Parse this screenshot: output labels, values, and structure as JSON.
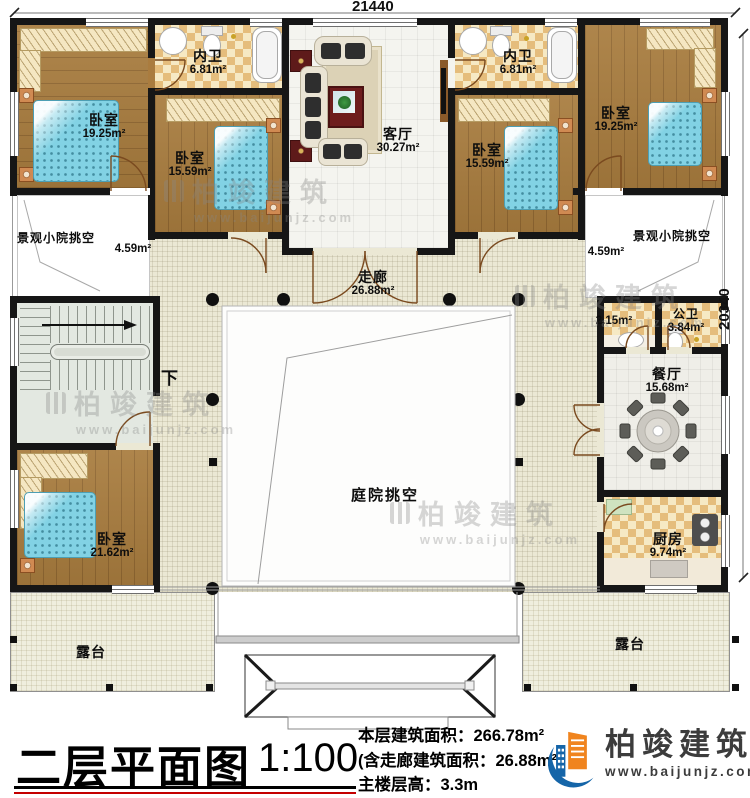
{
  "dimensions": {
    "width_top": "21440",
    "height_right": "20340"
  },
  "rooms": {
    "bedroom_top_left": {
      "label": "卧室",
      "area": "19.25m²"
    },
    "bath_left": {
      "label": "内卫",
      "area": "6.81m²"
    },
    "bedroom_mid_left": {
      "label": "卧室",
      "area": "15.59m²"
    },
    "living_room": {
      "label": "客厅",
      "area": "30.27m²"
    },
    "bath_right": {
      "label": "内卫",
      "area": "6.81m²"
    },
    "bedroom_mid_right": {
      "label": "卧室",
      "area": "15.59m²"
    },
    "bedroom_top_right": {
      "label": "卧室",
      "area": "19.25m²"
    },
    "court_left": {
      "label": "景观小院挑空",
      "area": "4.59m²"
    },
    "court_right": {
      "label": "景观小院挑空",
      "area": "4.59m²"
    },
    "corridor": {
      "label": "走廊",
      "area": "26.88m²"
    },
    "stairs": {
      "label": "下"
    },
    "bedroom_bottom_left": {
      "label": "卧室",
      "area": "21.62m²"
    },
    "washroom": {
      "area": "2.15m²"
    },
    "public_bath": {
      "label": "公卫",
      "area": "3.84m²"
    },
    "dining_room": {
      "label": "餐厅",
      "area": "15.68m²"
    },
    "kitchen": {
      "label": "厨房",
      "area": "9.74m²"
    },
    "courtyard_void": {
      "label": "庭院挑空"
    },
    "terrace_left": {
      "label": "露台"
    },
    "terrace_right": {
      "label": "露台"
    }
  },
  "title_block": {
    "title": "二层平面图",
    "scale": "1:100",
    "line1": "本层建筑面积：266.78m²",
    "line2": "(含走廊建筑面积：26.88m²)",
    "line3": "主楼层高：3.3m"
  },
  "logo": {
    "name": "柏竣建筑",
    "website": "www.baijunjz.com"
  },
  "watermark": {
    "name": "柏竣建筑",
    "website": "www.baijunjz.com"
  },
  "colors": {
    "wall": "#161616",
    "wood_floor": "#a87c3e",
    "tile_checker": "#e5bd7c",
    "corridor_floor": "#ebe8d4",
    "bed": "#82d2e4",
    "accent_red": "#6b1f1f",
    "logo_blue": "#1565a8",
    "logo_orange": "#f0841e",
    "underline_red": "#c40000"
  }
}
